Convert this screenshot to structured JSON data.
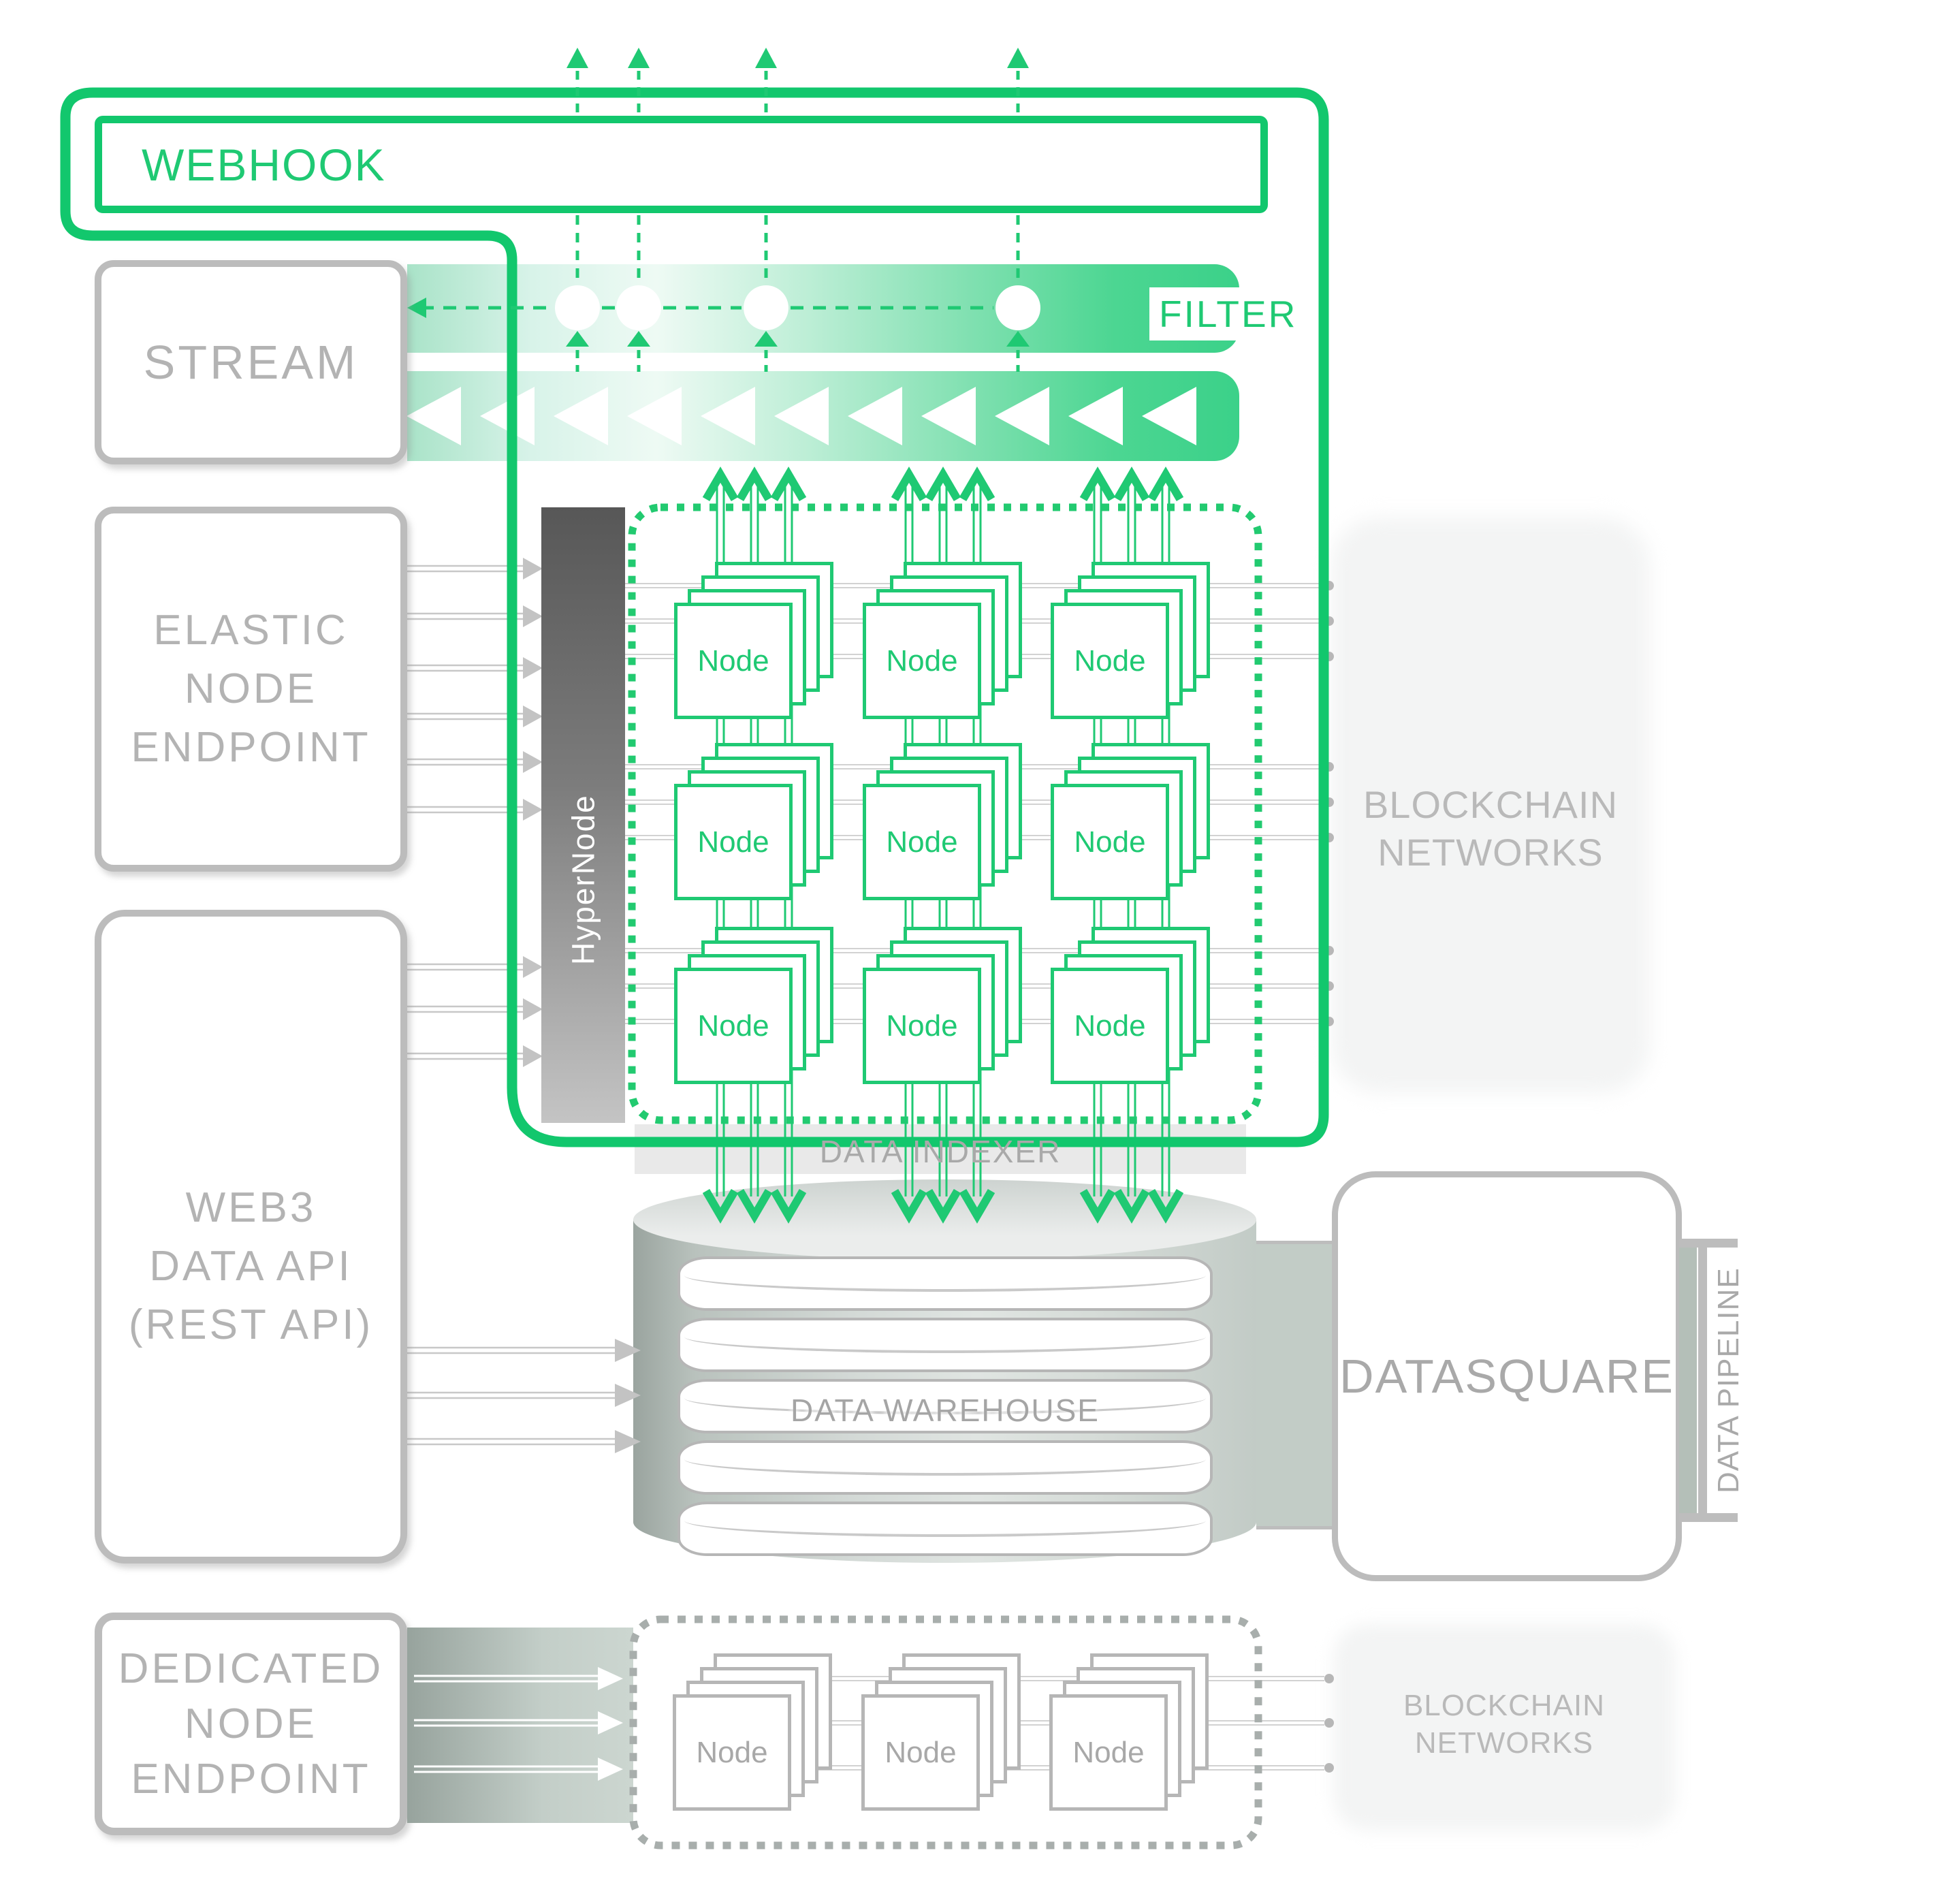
{
  "colors": {
    "green_accent": "#1fc973",
    "green_border": "#12c76d",
    "gray_border": "#bcbcbc",
    "gray_text": "#b3b3b3",
    "bar_gradient_end": "#3bd189",
    "band_gray_green": "#97a39d"
  },
  "webhook": {
    "label": "WEBHOOK"
  },
  "stream": {
    "label": "STREAM"
  },
  "filter": {
    "label": "FILTER"
  },
  "elastic": {
    "lines": [
      "ELASTIC",
      "NODE",
      "ENDPOINT"
    ]
  },
  "hypernode": {
    "label": "HyperNode"
  },
  "grid": {
    "node_label": "Node"
  },
  "blockchain_top": {
    "line1": "BLOCKCHAIN",
    "line2": "NETWORKS"
  },
  "blockchain_bottom": {
    "line1": "BLOCKCHAIN",
    "line2": "NETWORKS"
  },
  "web3": {
    "lines": [
      "WEB3",
      "DATA API",
      "(REST API)"
    ]
  },
  "indexer": {
    "label": "DATA INDEXER"
  },
  "warehouse": {
    "label": "DATA WAREHOUSE"
  },
  "datasquare": {
    "label": "DATASQUARE"
  },
  "pipeline": {
    "label": "DATA PIPELINE"
  },
  "dedicated": {
    "lines": [
      "DEDICATED",
      "NODE",
      "ENDPOINT"
    ]
  }
}
